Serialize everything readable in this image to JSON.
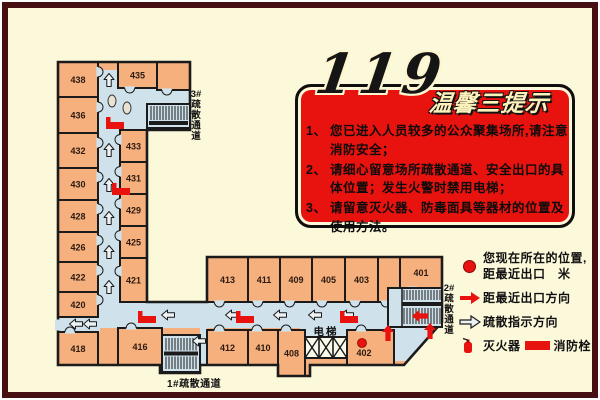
{
  "sign": {
    "number": "119",
    "title": "温馨三提示",
    "tips": [
      {
        "n": "1、",
        "t": "您已进入人员较多的公众聚集场所,请注意消防安全；"
      },
      {
        "n": "2、",
        "t": "请细心留意场所疏散通道、安全出口的具体位置；发生火警时禁用电梯；"
      },
      {
        "n": "3、",
        "t": "请留意灭火器、防毒面具等器材的位置及使用方法。"
      }
    ]
  },
  "legend": {
    "current_location_line1": "您现在所在的位置,",
    "current_location_line2": "距最近出口　米",
    "nearest_exit_direction": "距最近出口方向",
    "evacuation_direction": "疏散指示方向",
    "extinguisher": "灭火器",
    "hydrant": "消防栓"
  },
  "colors": {
    "background": "#fcf8da",
    "frame": "#471013",
    "room": "#f5b07e",
    "corridor": "#cfe2eb",
    "wall": "#1b1b1b",
    "red": "#e8120e",
    "arrow_fill": "#edf2f5",
    "number_text": "#2d1a0e"
  },
  "floorplan": {
    "outline": [
      [
        58,
        62
      ],
      [
        190,
        62
      ],
      [
        190,
        130
      ],
      [
        147,
        130
      ],
      [
        147,
        302
      ],
      [
        207,
        302
      ],
      [
        207,
        257
      ],
      [
        442,
        257
      ],
      [
        442,
        322
      ],
      [
        404,
        365
      ],
      [
        310,
        365
      ],
      [
        310,
        376
      ],
      [
        278,
        376
      ],
      [
        278,
        365
      ],
      [
        200,
        365
      ],
      [
        200,
        373
      ],
      [
        160,
        373
      ],
      [
        160,
        365
      ],
      [
        58,
        365
      ]
    ],
    "corridors": [
      {
        "type": "rect",
        "x": 98,
        "y": 70,
        "w": 22,
        "h": 258
      },
      {
        "type": "rect",
        "x": 98,
        "y": 88,
        "w": 92,
        "h": 42
      },
      {
        "type": "rect",
        "x": 98,
        "y": 302,
        "w": 344,
        "h": 26
      },
      {
        "type": "rect",
        "x": 388,
        "y": 288,
        "w": 54,
        "h": 39
      },
      {
        "type": "rect",
        "x": 300,
        "y": 328,
        "w": 104,
        "h": 10
      },
      {
        "type": "rect",
        "x": 58,
        "y": 317,
        "w": 42,
        "h": 15
      },
      {
        "type": "rect",
        "x": 200,
        "y": 328,
        "w": 7,
        "h": 37
      },
      {
        "type": "poly",
        "points": [
          [
            392,
            328
          ],
          [
            438,
            328
          ],
          [
            406,
            361
          ],
          [
            392,
            361
          ]
        ]
      }
    ],
    "wall_gaps": [
      {
        "x": 55,
        "y": 319.5,
        "w": 6,
        "h": 11
      }
    ],
    "rooms": [
      {
        "number": "438",
        "x": 58,
        "y": 62,
        "w": 40,
        "h": 35,
        "door": "E"
      },
      {
        "number": "436",
        "x": 58,
        "y": 97,
        "w": 40,
        "h": 36,
        "door": "E"
      },
      {
        "number": "432",
        "x": 58,
        "y": 133,
        "w": 40,
        "h": 35,
        "door": "E"
      },
      {
        "number": "430",
        "x": 58,
        "y": 168,
        "w": 40,
        "h": 32,
        "door": "E"
      },
      {
        "number": "428",
        "x": 58,
        "y": 200,
        "w": 40,
        "h": 32,
        "door": "E"
      },
      {
        "number": "426",
        "x": 58,
        "y": 232,
        "w": 40,
        "h": 30,
        "door": "E"
      },
      {
        "number": "422",
        "x": 58,
        "y": 262,
        "w": 40,
        "h": 30,
        "door": "E"
      },
      {
        "number": "420",
        "x": 58,
        "y": 292,
        "w": 40,
        "h": 25,
        "door": "E"
      },
      {
        "number": "418",
        "x": 58,
        "y": 332,
        "w": 40,
        "h": 33,
        "door": "N"
      },
      {
        "number": "435",
        "x": 118,
        "y": 62,
        "w": 39,
        "h": 26,
        "door": "S"
      },
      {
        "number": "",
        "x": 157,
        "y": 62,
        "w": 33,
        "h": 28,
        "door": "S"
      },
      {
        "number": "433",
        "x": 120,
        "y": 130,
        "w": 27,
        "h": 32,
        "door": "W"
      },
      {
        "number": "431",
        "x": 120,
        "y": 162,
        "w": 27,
        "h": 32,
        "door": "W"
      },
      {
        "number": "429",
        "x": 120,
        "y": 194,
        "w": 27,
        "h": 32,
        "door": "W"
      },
      {
        "number": "425",
        "x": 120,
        "y": 226,
        "w": 27,
        "h": 32,
        "door": "W"
      },
      {
        "number": "421",
        "x": 120,
        "y": 258,
        "w": 27,
        "h": 44,
        "door": "W"
      },
      {
        "number": "413",
        "x": 207,
        "y": 257,
        "w": 41,
        "h": 45,
        "door": "S"
      },
      {
        "number": "411",
        "x": 248,
        "y": 257,
        "w": 32,
        "h": 45,
        "door": "S"
      },
      {
        "number": "409",
        "x": 280,
        "y": 257,
        "w": 32,
        "h": 45,
        "door": "S"
      },
      {
        "number": "405",
        "x": 312,
        "y": 257,
        "w": 33,
        "h": 45,
        "door": "S"
      },
      {
        "number": "403",
        "x": 345,
        "y": 257,
        "w": 33,
        "h": 45,
        "door": "S"
      },
      {
        "number": "",
        "x": 378,
        "y": 257,
        "w": 22,
        "h": 45,
        "door": "S"
      },
      {
        "number": "401",
        "x": 400,
        "y": 257,
        "w": 42,
        "h": 31,
        "door": "S"
      },
      {
        "number": "416",
        "x": 118,
        "y": 328,
        "w": 44,
        "h": 37,
        "door": "N"
      },
      {
        "number": "412",
        "x": 207,
        "y": 330,
        "w": 41,
        "h": 35,
        "door": "N"
      },
      {
        "number": "410",
        "x": 248,
        "y": 330,
        "w": 30,
        "h": 35,
        "door": "N"
      },
      {
        "number": "408",
        "x": 278,
        "y": 330,
        "w": 27,
        "h": 46,
        "door": "N"
      },
      {
        "number": "402",
        "x": 347,
        "y": 330,
        "w": 47,
        "h": 35,
        "door": "N",
        "lx": 364,
        "ly": 356
      }
    ],
    "stairs": [
      {
        "id": "stairwell-3",
        "x": 147,
        "y": 104,
        "w": 43,
        "h": 24,
        "kind": "bottombar"
      },
      {
        "id": "stairwell-1",
        "x": 162,
        "y": 335,
        "w": 38,
        "h": 37,
        "kind": "middlebar"
      },
      {
        "id": "stairwell-2",
        "x": 388,
        "y": 288,
        "w": 54,
        "h": 39,
        "kind": "flights"
      }
    ],
    "elevator": {
      "x": 305,
      "y": 337,
      "w": 42,
      "h": 21,
      "label": "电梯",
      "label_x": 326,
      "label_y": 335
    },
    "fixtures": [
      {
        "cx": 112,
        "cy": 101,
        "rx": 4,
        "ry": 6
      },
      {
        "cx": 127,
        "cy": 108,
        "rx": 4,
        "ry": 6
      }
    ],
    "guide_arrows": [
      {
        "x": 109,
        "y": 80,
        "dir": "up"
      },
      {
        "x": 109,
        "y": 150,
        "dir": "up"
      },
      {
        "x": 109,
        "y": 185,
        "dir": "up"
      },
      {
        "x": 109,
        "y": 218,
        "dir": "up"
      },
      {
        "x": 109,
        "y": 252,
        "dir": "up"
      },
      {
        "x": 109,
        "y": 287,
        "dir": "up"
      },
      {
        "x": 76,
        "y": 324,
        "dir": "left"
      },
      {
        "x": 90,
        "y": 324,
        "dir": "left"
      },
      {
        "x": 168,
        "y": 315,
        "dir": "left"
      },
      {
        "x": 232,
        "y": 315,
        "dir": "left"
      },
      {
        "x": 280,
        "y": 315,
        "dir": "left"
      },
      {
        "x": 315,
        "y": 315,
        "dir": "left"
      },
      {
        "x": 347,
        "y": 315,
        "dir": "left"
      },
      {
        "x": 199,
        "y": 341,
        "dir": "left"
      }
    ],
    "exit_arrows": [
      {
        "x": 388,
        "y": 333,
        "dir": "up"
      },
      {
        "x": 430,
        "y": 331,
        "dir": "up"
      },
      {
        "x": 420,
        "y": 316,
        "dir": "left"
      }
    ],
    "hydrants": [
      [
        106,
        117
      ],
      [
        112,
        183
      ],
      [
        138,
        311
      ],
      [
        236,
        311
      ],
      [
        340,
        311
      ]
    ],
    "you_are_here": {
      "x": 362,
      "y": 343
    },
    "channel_labels": [
      {
        "text": "3#疏散通道",
        "x": 196,
        "y": 97,
        "vertical": true
      },
      {
        "text": "2#疏散通道",
        "x": 449,
        "y": 291,
        "vertical": true
      },
      {
        "text": "1#疏散通道",
        "x": 167,
        "y": 387,
        "vertical": false
      }
    ]
  }
}
